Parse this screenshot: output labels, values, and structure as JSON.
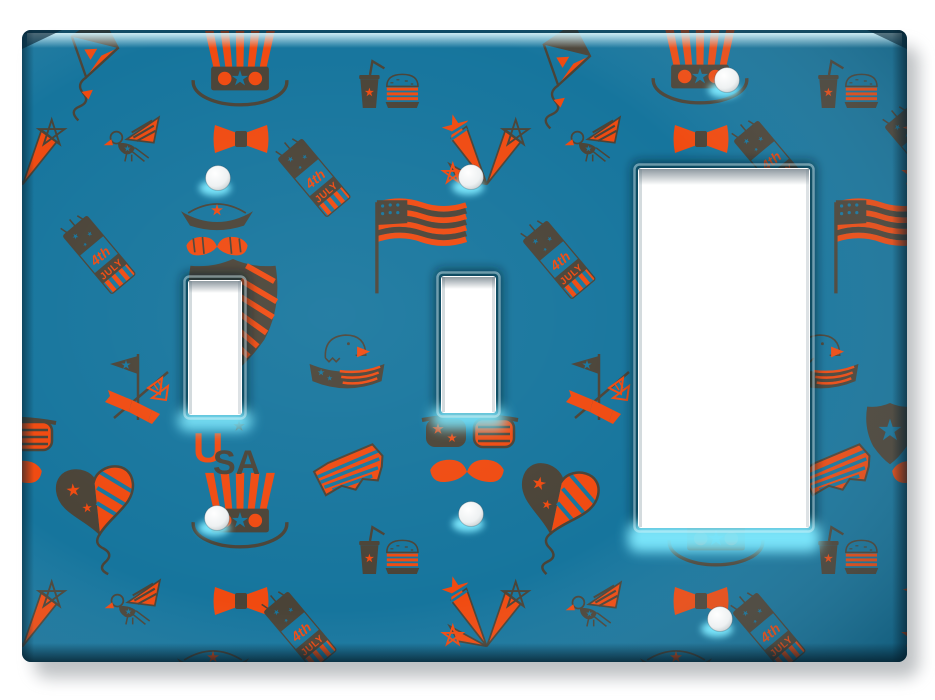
{
  "colors": {
    "plate_teal": "#16759d",
    "accent_orange": "#f04a10",
    "icon_brown": "#4a4337",
    "bevel_highlight": "#cdeaf0",
    "glow_cyan": "#7feaff",
    "opening_white": "#ffffff",
    "page_background": "#ffffff",
    "drop_shadow": "#8a9094"
  },
  "plate": {
    "x": 22,
    "y": 30,
    "width": 885,
    "height": 632,
    "corner_radius": 9
  },
  "openings": [
    {
      "kind": "toggle",
      "x": 188,
      "y": 280,
      "width": 54,
      "height": 135
    },
    {
      "kind": "toggle",
      "x": 441,
      "y": 276,
      "width": 55,
      "height": 137
    },
    {
      "kind": "rocker",
      "x": 638,
      "y": 168,
      "width": 172,
      "height": 360
    }
  ],
  "screws": [
    {
      "x": 218,
      "y": 178
    },
    {
      "x": 471,
      "y": 177
    },
    {
      "x": 727,
      "y": 80
    },
    {
      "x": 217,
      "y": 518
    },
    {
      "x": 471,
      "y": 514
    },
    {
      "x": 720,
      "y": 619
    }
  ],
  "pattern": {
    "theme": "4th of July",
    "texts": {
      "firecracker_line1": "4th",
      "firecracker_line2": "JULY",
      "usa_first": "U",
      "usa_rest": "SA"
    },
    "icons": [
      "uncle-sam-hat",
      "bow-tie",
      "kite",
      "heart-kite",
      "eagle",
      "eagle-banner",
      "firecracker",
      "us-flag",
      "soda-and-burger",
      "star-firework",
      "sunglasses",
      "mustache",
      "usa-text",
      "usa-map",
      "pennant-flags",
      "shield",
      "sailor-hat-mustache"
    ],
    "placements": [
      {
        "icon": "hat",
        "x": 240,
        "y": 70,
        "r": 0,
        "s": 0.85
      },
      {
        "icon": "hat",
        "x": 700,
        "y": 68,
        "r": 0,
        "s": 0.85
      },
      {
        "icon": "hat",
        "x": 240,
        "y": 512,
        "r": 0,
        "s": 0.85
      },
      {
        "icon": "hat",
        "x": 716,
        "y": 530,
        "r": 0,
        "s": 0.85
      },
      {
        "icon": "boat-mustache",
        "x": 217,
        "y": 222,
        "r": 0,
        "s": 0.9
      },
      {
        "icon": "boat-mustache",
        "x": 213,
        "y": 669,
        "r": 0,
        "s": 0.9
      },
      {
        "icon": "boat-mustache",
        "x": 676,
        "y": 669,
        "r": 0,
        "s": 0.9
      },
      {
        "icon": "bowtie",
        "x": 241,
        "y": 139,
        "r": 0,
        "s": 1
      },
      {
        "icon": "bowtie",
        "x": 701,
        "y": 139,
        "r": 0,
        "s": 1
      },
      {
        "icon": "bowtie",
        "x": 241,
        "y": 601,
        "r": 0,
        "s": 1
      },
      {
        "icon": "bowtie",
        "x": 701,
        "y": 601,
        "r": 0,
        "s": 1
      },
      {
        "icon": "kite",
        "x": 94,
        "y": 46,
        "r": 14,
        "s": 0.95
      },
      {
        "icon": "kite",
        "x": 566,
        "y": 54,
        "r": 14,
        "s": 0.95
      },
      {
        "icon": "heart-kite",
        "x": 96,
        "y": 496,
        "r": -6,
        "s": 1
      },
      {
        "icon": "heart-kite",
        "x": 559,
        "y": 496,
        "r": 12,
        "s": 1
      },
      {
        "icon": "eagle",
        "x": 130,
        "y": 141,
        "r": 0,
        "s": 0.85
      },
      {
        "icon": "eagle",
        "x": 591,
        "y": 141,
        "r": 0,
        "s": 0.85
      },
      {
        "icon": "eagle",
        "x": 131,
        "y": 604,
        "r": 0,
        "s": 0.85
      },
      {
        "icon": "eagle",
        "x": 592,
        "y": 606,
        "r": 0,
        "s": 0.85
      },
      {
        "icon": "eagle-banner",
        "x": 347,
        "y": 361,
        "r": 0,
        "s": 0.72
      },
      {
        "icon": "eagle-banner",
        "x": 821,
        "y": 361,
        "r": 0,
        "s": 0.72
      },
      {
        "icon": "firecracker",
        "x": 101,
        "y": 257,
        "r": -40,
        "s": 0.52
      },
      {
        "icon": "firecracker",
        "x": 561,
        "y": 262,
        "r": -40,
        "s": 0.52
      },
      {
        "icon": "firecracker",
        "x": 316,
        "y": 180,
        "r": -40,
        "s": 0.52
      },
      {
        "icon": "firecracker",
        "x": 772,
        "y": 162,
        "r": -40,
        "s": 0.52
      },
      {
        "icon": "firecracker",
        "x": 302,
        "y": 633,
        "r": -40,
        "s": 0.52
      },
      {
        "icon": "firecracker",
        "x": 771,
        "y": 634,
        "r": -40,
        "s": 0.52
      },
      {
        "icon": "firecracker",
        "x": 923,
        "y": 148,
        "r": -40,
        "s": 0.52
      },
      {
        "icon": "flag",
        "x": 413,
        "y": 244,
        "r": 0,
        "s": 0.95
      },
      {
        "icon": "flag",
        "x": 872,
        "y": 244,
        "r": 0,
        "s": 0.95
      },
      {
        "icon": "soda-burger",
        "x": 388,
        "y": 90,
        "r": 0,
        "s": 0.6
      },
      {
        "icon": "soda-burger",
        "x": 847,
        "y": 90,
        "r": 0,
        "s": 0.6
      },
      {
        "icon": "soda-burger",
        "x": 388,
        "y": 556,
        "r": 0,
        "s": 0.6
      },
      {
        "icon": "soda-burger",
        "x": 847,
        "y": 556,
        "r": 0,
        "s": 0.6
      },
      {
        "icon": "starburst",
        "x": 480,
        "y": 152,
        "r": 0,
        "s": 0.85
      },
      {
        "icon": "starburst",
        "x": 480,
        "y": 614,
        "r": 0,
        "s": 0.85
      },
      {
        "icon": "starburst",
        "x": 16,
        "y": 152,
        "r": 0,
        "s": 0.85
      },
      {
        "icon": "starburst",
        "x": 16,
        "y": 614,
        "r": 0,
        "s": 0.85
      },
      {
        "icon": "starburst",
        "x": 941,
        "y": 152,
        "r": 0,
        "s": 0.85
      },
      {
        "icon": "starburst",
        "x": 941,
        "y": 614,
        "r": 0,
        "s": 0.85
      },
      {
        "icon": "sunglasses",
        "x": 470,
        "y": 431,
        "r": 0,
        "s": 1
      },
      {
        "icon": "sunglasses",
        "x": 8,
        "y": 434,
        "r": 0,
        "s": 1
      },
      {
        "icon": "mustache",
        "x": 467,
        "y": 470,
        "r": 0,
        "s": 0.92
      },
      {
        "icon": "mustache",
        "x": 5,
        "y": 471,
        "r": 0,
        "s": 0.92
      },
      {
        "icon": "mustache",
        "x": 929,
        "y": 471,
        "r": 0,
        "s": 0.92
      },
      {
        "icon": "usa-text",
        "x": 221,
        "y": 444,
        "r": 0,
        "s": 1
      },
      {
        "icon": "usa-map",
        "x": 352,
        "y": 472,
        "r": -18,
        "s": 1
      },
      {
        "icon": "usa-map",
        "x": 839,
        "y": 472,
        "r": -18,
        "s": 1
      },
      {
        "icon": "pennant",
        "x": 138,
        "y": 388,
        "r": 0,
        "s": 1
      },
      {
        "icon": "pennant",
        "x": 599,
        "y": 388,
        "r": 0,
        "s": 1
      },
      {
        "icon": "shield",
        "x": 233,
        "y": 315,
        "r": 0,
        "s": 1.12
      },
      {
        "icon": "shield-star",
        "x": 890,
        "y": 433,
        "r": 0,
        "s": 0.6
      }
    ]
  }
}
